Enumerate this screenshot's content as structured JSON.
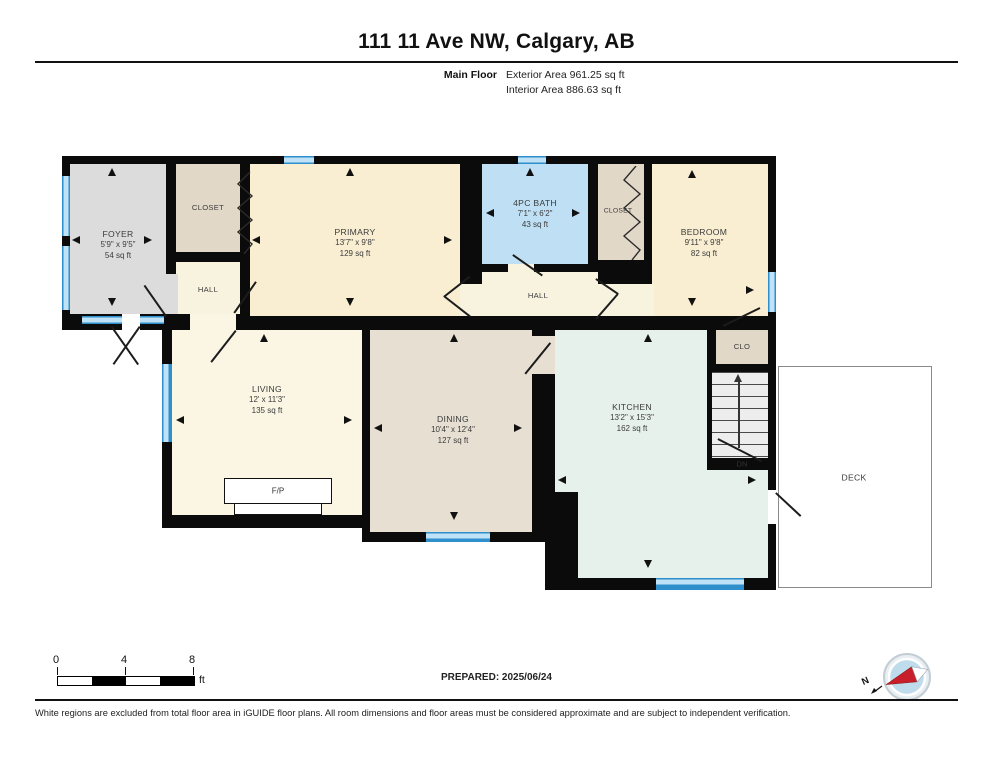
{
  "header": {
    "title": "111 11 Ave NW, Calgary, AB",
    "floor_label": "Main Floor",
    "exterior_area": "Exterior Area 961.25 sq ft",
    "interior_area": "Interior Area 886.63 sq ft"
  },
  "rooms": {
    "foyer": {
      "name": "FOYER",
      "dims": "5'9\" x 9'5\"",
      "area": "54 sq ft"
    },
    "closet_top": {
      "name": "CLOSET"
    },
    "hall_left": {
      "name": "HALL"
    },
    "primary": {
      "name": "PRIMARY",
      "dims": "13'7\" x 9'8\"",
      "area": "129 sq ft"
    },
    "bath": {
      "name": "4PC BATH",
      "dims": "7'1\" x 6'2\"",
      "area": "43 sq ft"
    },
    "closet_right": {
      "name": "CLOSET"
    },
    "bedroom": {
      "name": "BEDROOM",
      "dims": "9'11\" x 9'8\"",
      "area": "82 sq ft"
    },
    "hall_center": {
      "name": "HALL"
    },
    "living": {
      "name": "LIVING",
      "dims": "12' x 11'3\"",
      "area": "135 sq ft"
    },
    "dining": {
      "name": "DINING",
      "dims": "10'4\" x 12'4\"",
      "area": "127 sq ft"
    },
    "kitchen": {
      "name": "KITCHEN",
      "dims": "13'2\" x 15'3\"",
      "area": "162 sq ft"
    },
    "clo": {
      "name": "CLO"
    },
    "deck": {
      "name": "DECK"
    },
    "fireplace": {
      "name": "F/P"
    },
    "stairs": {
      "down_label": "DN"
    }
  },
  "footer": {
    "scale": {
      "tick0": "0",
      "tick1": "4",
      "tick2": "8",
      "unit": "ft"
    },
    "prepared": "PREPARED: 2025/06/24",
    "compass_north": "N",
    "disclaimer": "White regions are excluded from total floor area in iGUIDE floor plans. All room dimensions and floor areas must be considered approximate and are subject to independent verification."
  },
  "colors": {
    "wall": "#0b0b0b",
    "window_blue": "#4a9fd6",
    "cream": "#f9eed2",
    "tan": "#e2d8c8",
    "gray": "#dcdcdc",
    "bath_blue": "#bfe0f4",
    "pale": "#f8f3df",
    "living": "#faf6e3",
    "taupe": "#e6dfd2",
    "mint": "#e7f1ec",
    "stairs": "#ededed",
    "deck": "#ffffff",
    "compass_red": "#c8202a",
    "entry_white": "#ffffff"
  }
}
